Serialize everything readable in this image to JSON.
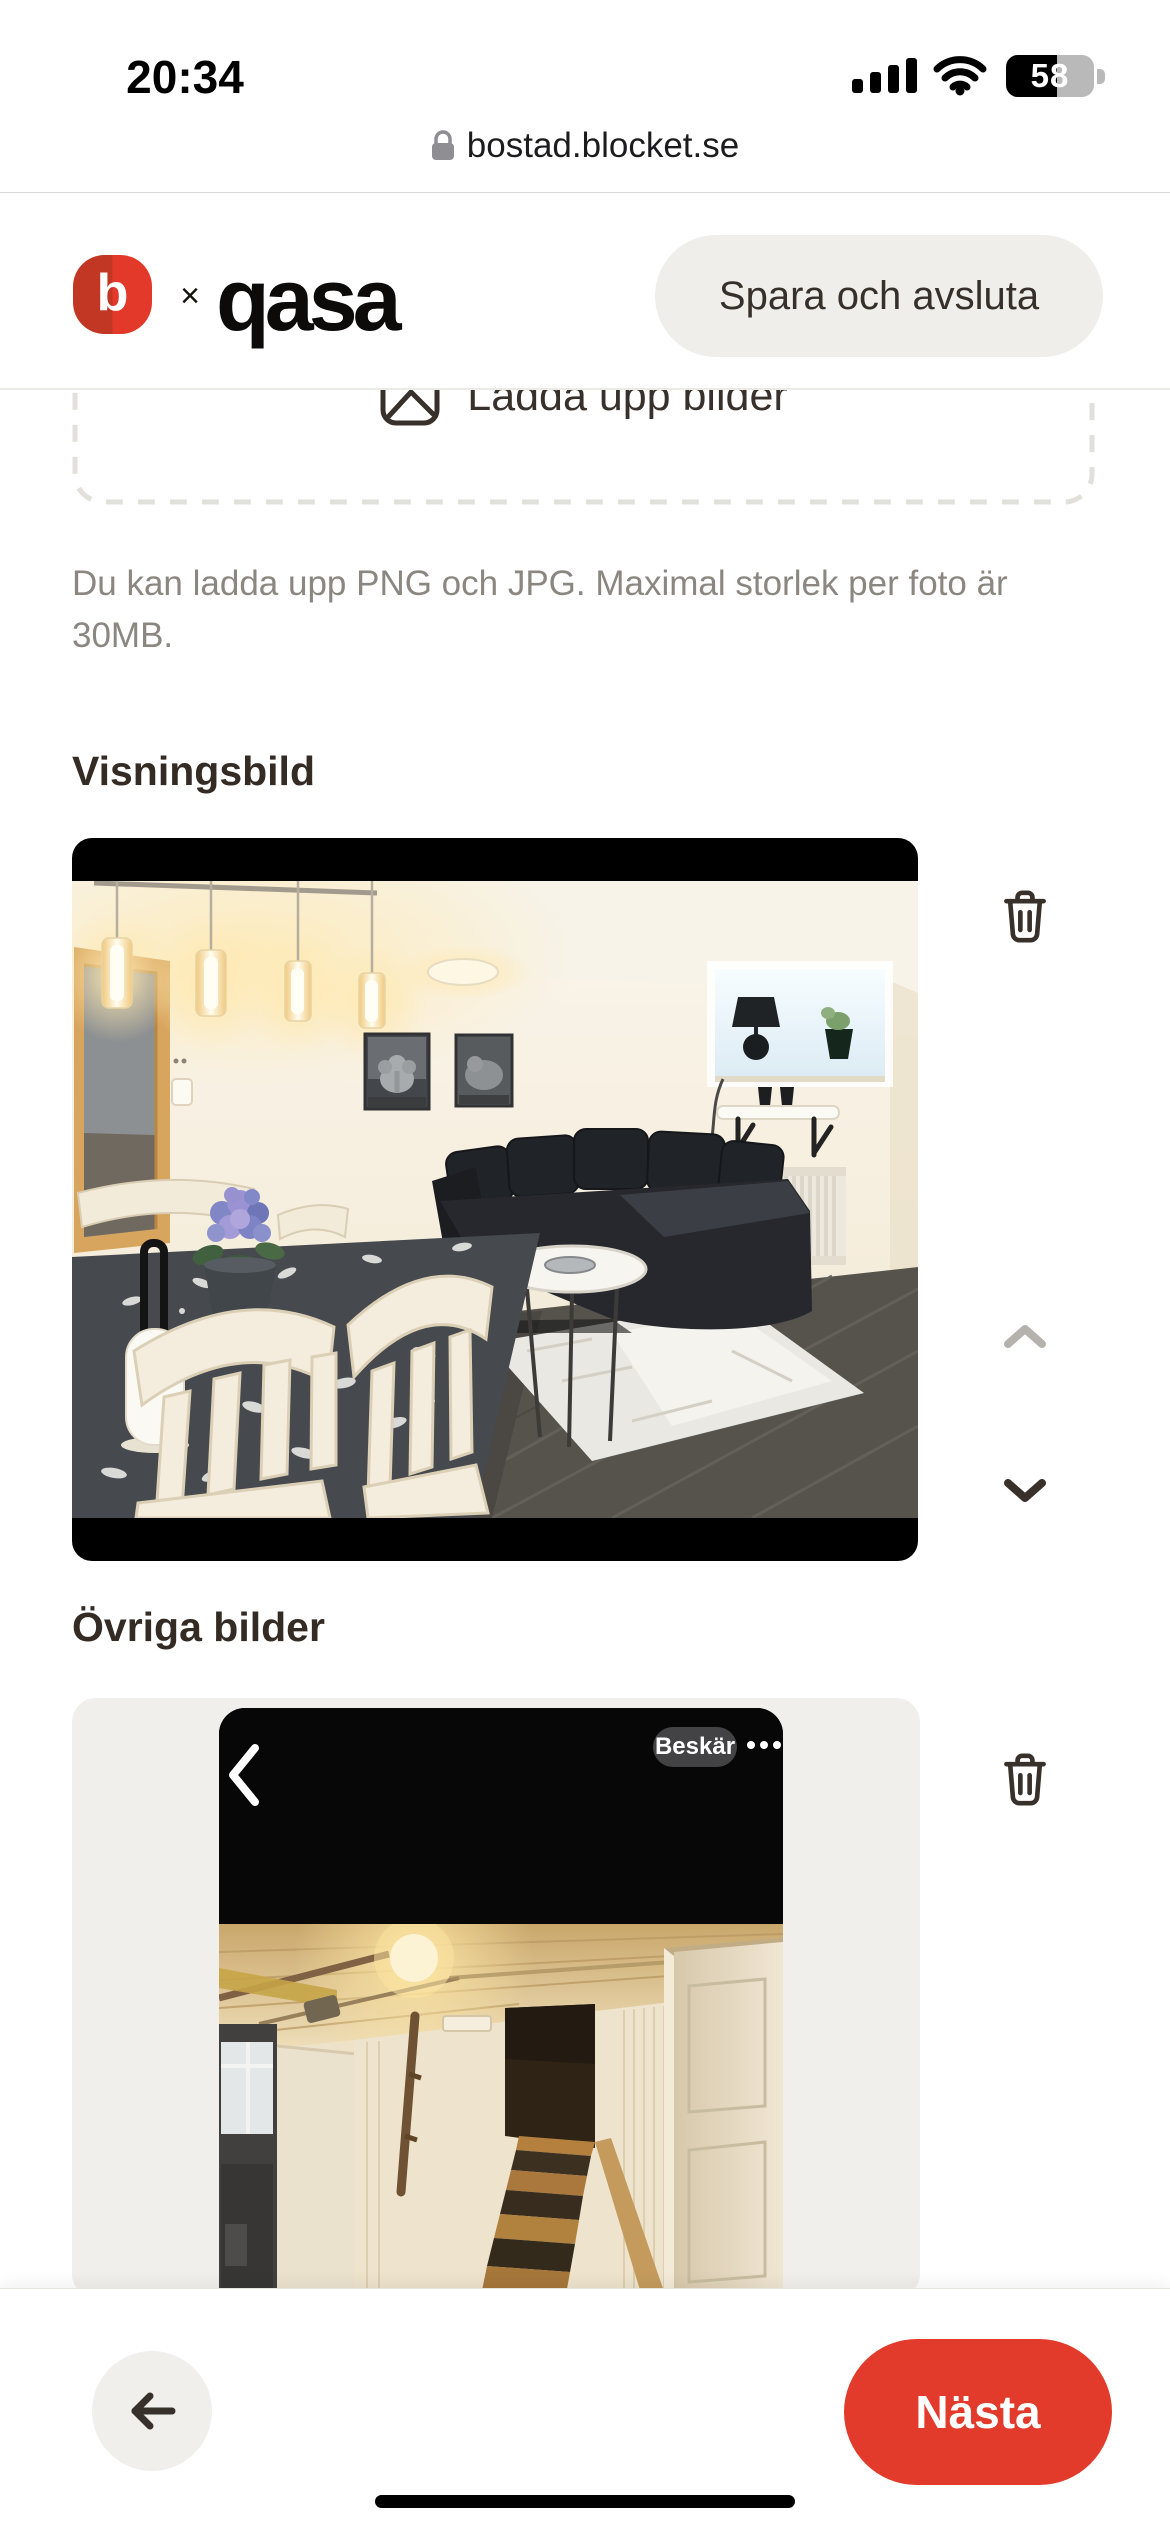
{
  "status_bar": {
    "time": "20:34",
    "battery_level": "58"
  },
  "browser_bar": {
    "domain": "bostad.blocket.se"
  },
  "header": {
    "blocket_logo_letter": "b",
    "logo_separator": "×",
    "qasa_logo": "qasa",
    "save_exit_button": "Spara och avsluta"
  },
  "upload_area": {
    "upload_button_label": "Ladda upp bilder",
    "hint_line_1": "Du kan ladda upp PNG och JPG. Maximal storlek per foto är",
    "hint_line_2": "30MB."
  },
  "sections": {
    "main_image_title": "Visningsbild",
    "other_images_title": "Övriga bilder"
  },
  "embedded_photo_overlay": {
    "crop_button": "Beskär"
  },
  "footer": {
    "next_button": "Nästa"
  },
  "colors": {
    "brand_red": "#e23a2b",
    "header_pill_bg": "#efeeea",
    "card_bg": "#f0efeb",
    "heading_text": "#342c24",
    "muted_text": "#8b8780",
    "disabled_chevron": "#b5b2ae",
    "icon_dark": "#38302a"
  },
  "icons": {
    "lock": "padlock",
    "cellular": "signal-bars",
    "wifi": "wifi-arcs",
    "battery": "battery-fill-58",
    "upload_image": "picture",
    "delete": "trash-can",
    "move_up": "chevron-up",
    "move_down": "chevron-down",
    "embedded_back": "chevron-left",
    "embedded_more": "ellipsis",
    "back": "arrow-left"
  }
}
